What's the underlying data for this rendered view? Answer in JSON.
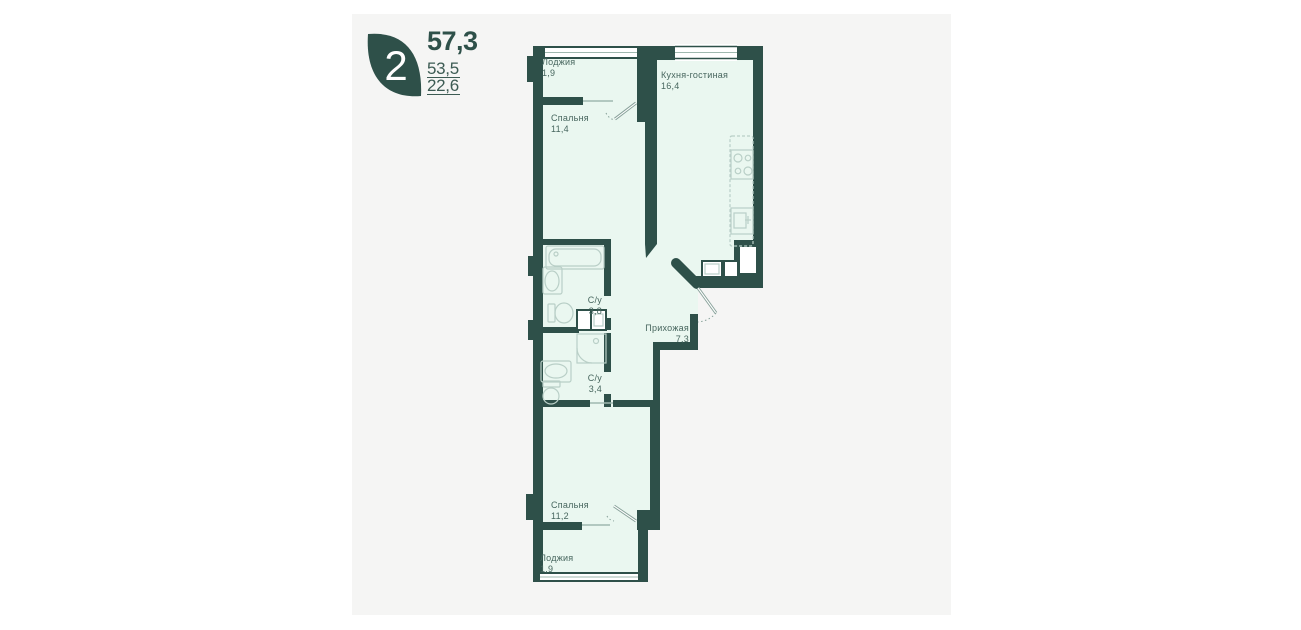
{
  "logo": {
    "rooms_count": "2",
    "leaf_color": "#2e5049"
  },
  "areas": {
    "total": "57,3",
    "second": "53,5",
    "third": "22,6"
  },
  "rooms": [
    {
      "id": "loggia-top",
      "name": "Лоджия",
      "area": "1,9"
    },
    {
      "id": "bedroom-top",
      "name": "Спальня",
      "area": "11,4"
    },
    {
      "id": "kitchen-living",
      "name": "Кухня-гостиная",
      "area": "16,4"
    },
    {
      "id": "bath-top",
      "name": "С/у",
      "area": "3,8"
    },
    {
      "id": "hallway",
      "name": "Прихожая",
      "area": "7,3"
    },
    {
      "id": "bath-bottom",
      "name": "С/у",
      "area": "3,4"
    },
    {
      "id": "bedroom-bottom",
      "name": "Спальня",
      "area": "11,2"
    },
    {
      "id": "loggia-bottom",
      "name": "Лоджия",
      "area": "1,9"
    }
  ],
  "colors": {
    "wall": "#2e5049",
    "room_fill": "#eaf7f0",
    "panel_bg": "#f5f5f4",
    "fixture_stroke": "#b9cfc7",
    "label_text": "#47665e"
  }
}
